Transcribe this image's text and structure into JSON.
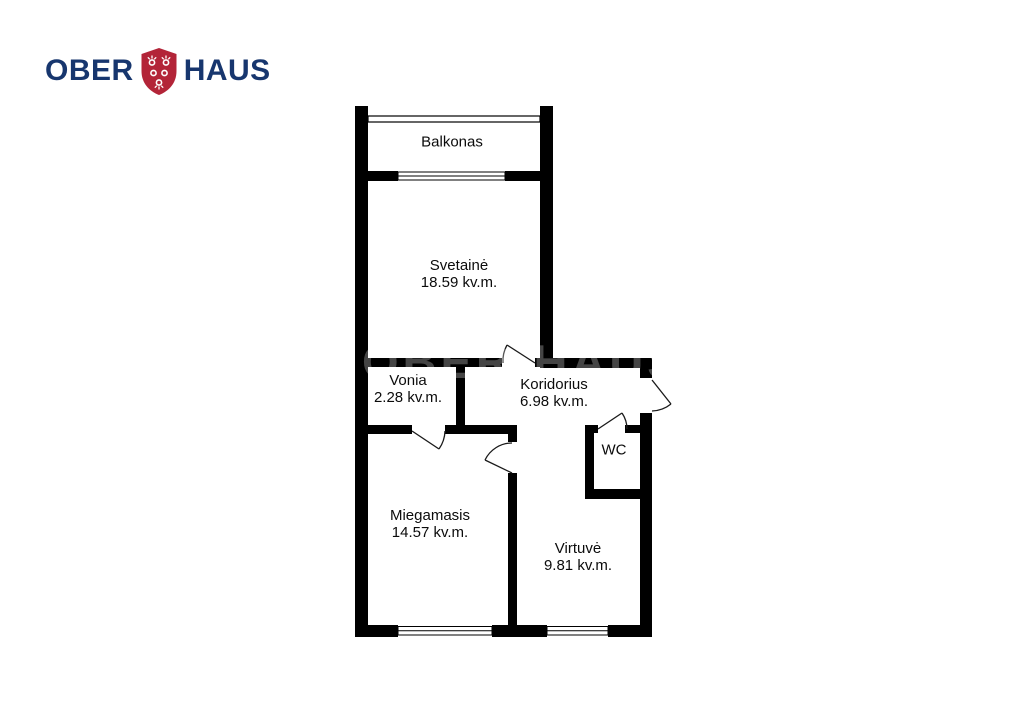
{
  "logo": {
    "word1": "OBER",
    "word2": "HAUS"
  },
  "watermark": {
    "text": "OBER-HAUS"
  },
  "plan": {
    "rooms": [
      {
        "name": "Balkonas",
        "area": ""
      },
      {
        "name": "Svetainė",
        "area": "18.59 kv.m."
      },
      {
        "name": "Vonia",
        "area": "2.28 kv.m."
      },
      {
        "name": "Koridorius",
        "area": "6.98 kv.m."
      },
      {
        "name": "WC",
        "area": ""
      },
      {
        "name": "Miegamasis",
        "area": "14.57 kv.m."
      },
      {
        "name": "Virtuvė",
        "area": "9.81 kv.m."
      }
    ],
    "colors": {
      "walls": "#000000",
      "logo_text": "#17366e",
      "logo_shield": "#b32438"
    }
  }
}
